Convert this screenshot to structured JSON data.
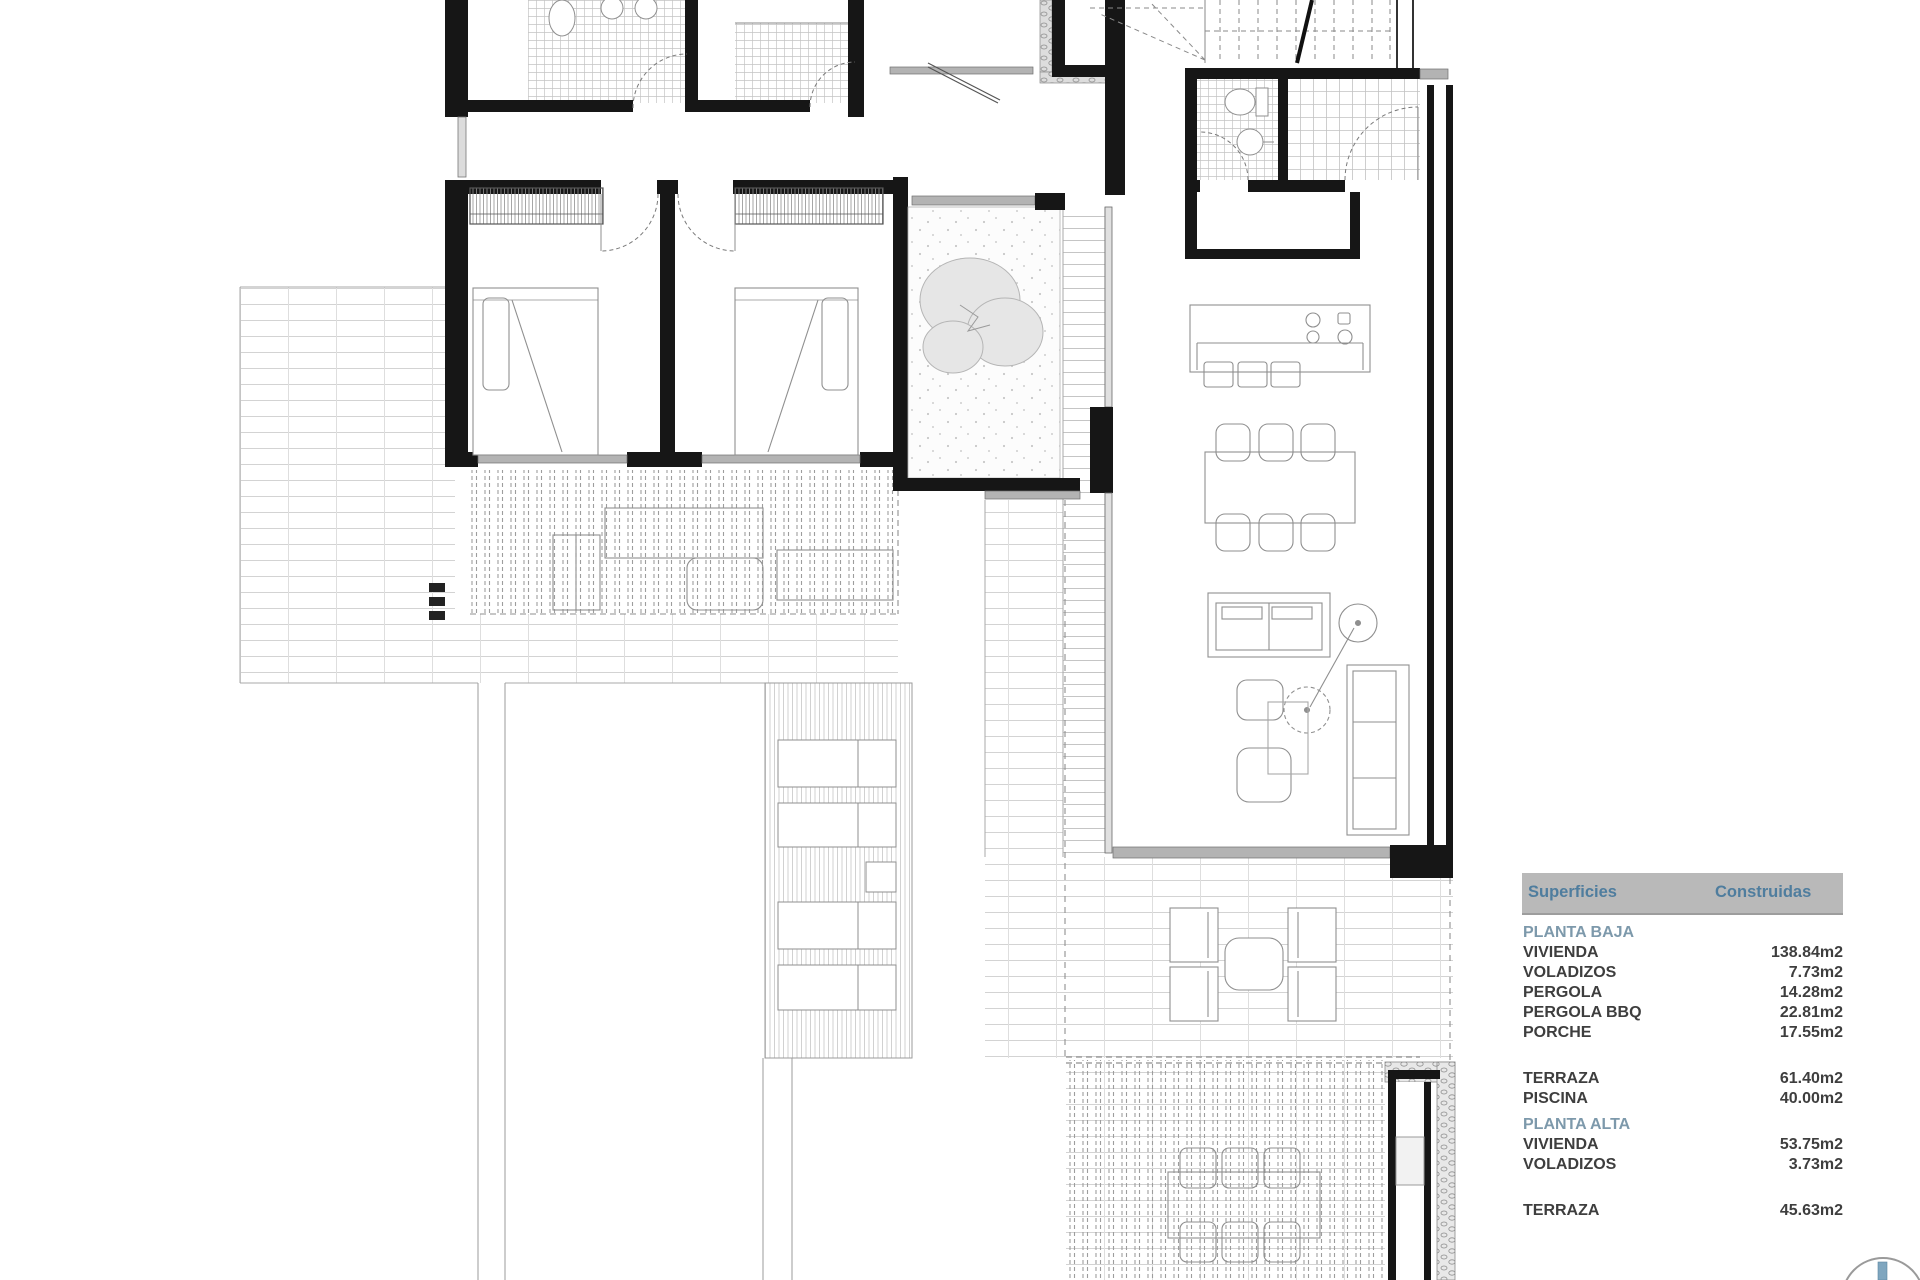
{
  "legend": {
    "header": {
      "col1": "Superficies",
      "col2": "Construidas"
    },
    "rows": [
      {
        "type": "section",
        "label": "PLANTA BAJA",
        "value": ""
      },
      {
        "type": "item",
        "label": "VIVIENDA",
        "value": "138.84m2"
      },
      {
        "type": "item",
        "label": "VOLADIZOS",
        "value": "7.73m2"
      },
      {
        "type": "item",
        "label": "PERGOLA",
        "value": "14.28m2"
      },
      {
        "type": "item",
        "label": "PERGOLA BBQ",
        "value": "22.81m2"
      },
      {
        "type": "item",
        "label": "PORCHE",
        "value": "17.55m2"
      },
      {
        "type": "spacer",
        "label": "",
        "value": ""
      },
      {
        "type": "item",
        "label": "TERRAZA",
        "value": "61.40m2"
      },
      {
        "type": "item",
        "label": "PISCINA",
        "value": "40.00m2"
      },
      {
        "type": "section",
        "label": "PLANTA ALTA",
        "value": ""
      },
      {
        "type": "item",
        "label": "VIVIENDA",
        "value": "53.75m2"
      },
      {
        "type": "item",
        "label": "VOLADIZOS",
        "value": "3.73m2"
      },
      {
        "type": "spacer",
        "label": "",
        "value": ""
      },
      {
        "type": "item",
        "label": "TERRAZA",
        "value": "45.63m2"
      }
    ]
  },
  "colors": {
    "header_text": "#4f7d9e",
    "section_text": "#7d99ab",
    "body_text": "#3e3e3e",
    "header_bar": "#b9b9b9",
    "wall": "#161616",
    "compass_accent": "#7fa6bf"
  }
}
